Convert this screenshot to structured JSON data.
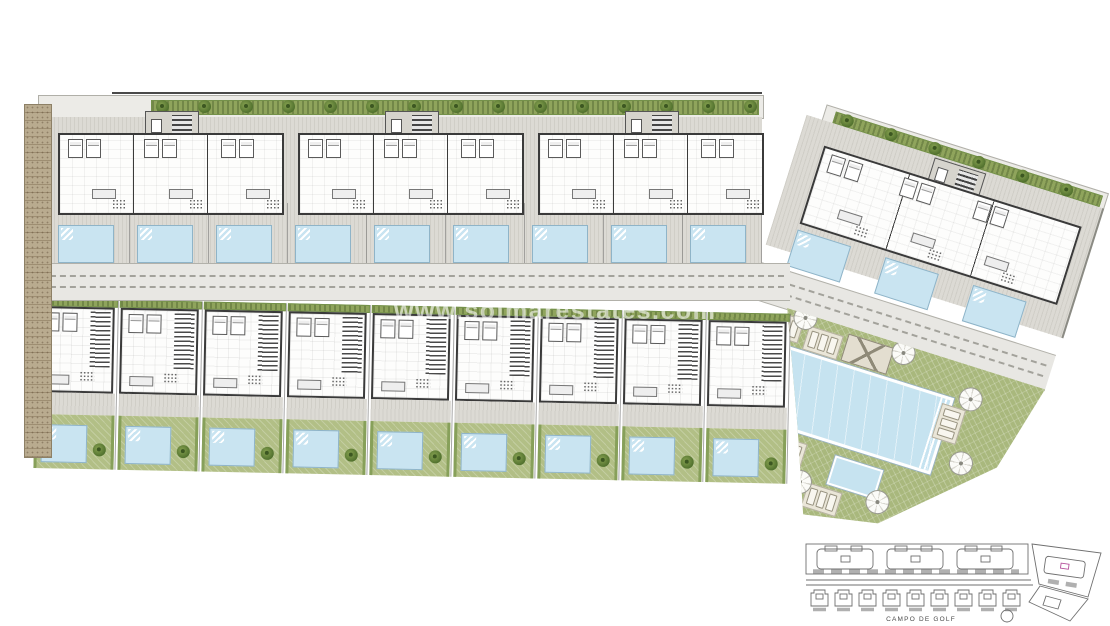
{
  "watermark": {
    "text": "www.solmarestates.com"
  },
  "keyplan": {
    "caption": "CAMPO DE GOLF"
  },
  "plan": {
    "colors": {
      "pavement": "#dcdad4",
      "walls": "#3a3a3a",
      "hedge": "#8fa45c",
      "lawn": "#a9b87d",
      "pool_water": "#c6e3f0",
      "road": "#e8e7e3",
      "side_path": "#b9ab8f",
      "keyplan_label": "#b5519c"
    },
    "top_row": {
      "building_count": 3,
      "pool_count": 9,
      "tree_count": 15
    },
    "townhouses": {
      "count": 9
    },
    "east_wing": {
      "building_count": 1,
      "pool_count": 3,
      "tree_count": 6
    },
    "community": {
      "parasol_count": 8,
      "deck_count": 6,
      "has_main_pool": true,
      "has_kids_pool": true
    }
  }
}
